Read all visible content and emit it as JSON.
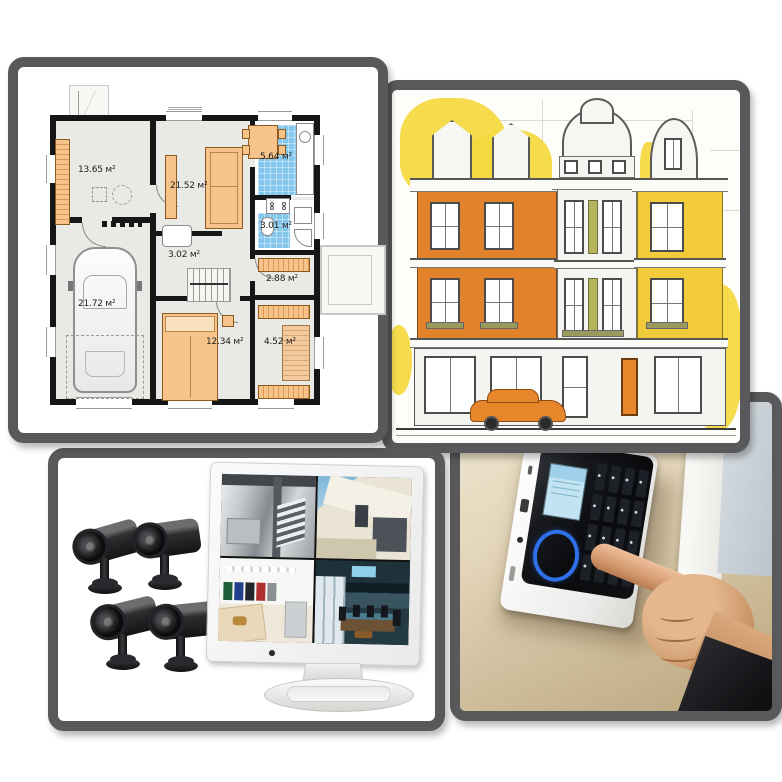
{
  "collage": {
    "description": "2x2 collage: house floor plan, architectural facade sketch, CCTV camera kit with monitor, wall alarm keypad being pressed",
    "frame_color": "#59595b",
    "background": "#ffffff"
  },
  "floor_plan": {
    "unit": "м²",
    "rooms": [
      {
        "name": "hallway",
        "label": "13.65 м²"
      },
      {
        "name": "living-room",
        "label": "21.52 м²"
      },
      {
        "name": "kitchen",
        "label": "5.64 м²"
      },
      {
        "name": "bathroom",
        "label": "3.01 м²"
      },
      {
        "name": "inner-hall",
        "label": "3.02 м²"
      },
      {
        "name": "entry-terrace",
        "label": "2.88 м²"
      },
      {
        "name": "garage",
        "label": "21.72 м²"
      },
      {
        "name": "bedroom",
        "label": "12.34 м²"
      },
      {
        "name": "wardrobe",
        "label": "4.52 м²"
      }
    ],
    "colors": {
      "walls": "#161616",
      "furniture": "#f6c38b",
      "tiles": "#85c6ec",
      "floor": "#e9e9e6"
    }
  },
  "facade_sketch": {
    "colors": {
      "left_house": "#e2822a",
      "right_house": "#f2cb3a",
      "foliage": "#f5d83e",
      "car": "#e8862c",
      "door": "#e8862c"
    },
    "elements": [
      "three-townhouse-facade",
      "yellow-trees",
      "orange-car",
      "blueprint-pencil-lines"
    ]
  },
  "cctv_kit": {
    "camera_count": 4,
    "monitor_feeds": [
      "interior-staircase",
      "modern-house-exterior",
      "clothing-store",
      "conference-room"
    ],
    "monitor_color": "#f2f3f2"
  },
  "alarm_keypad": {
    "colors": {
      "lcd": "#c2e4f2",
      "ring": "#2f6fe8",
      "glass": "#101114",
      "wall": "#e0d2b4"
    },
    "elements": [
      "wall-mounted-keypad",
      "lcd-screen",
      "key-grid-4x4",
      "blue-ring-button",
      "pressing-finger",
      "black-sleeve"
    ]
  }
}
